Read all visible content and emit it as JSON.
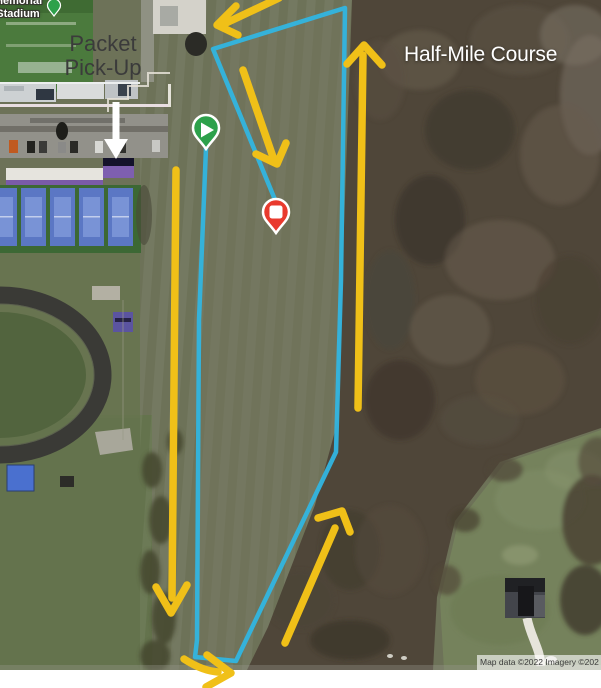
{
  "labels": {
    "packet_line1": "Packet",
    "packet_line2": "Pick-Up",
    "course": "Half-Mile Course",
    "stadium_line1": "Memorial",
    "stadium_line2": "Stadium",
    "attribution": "Map data ©2022 Imagery ©202"
  },
  "course": {
    "line_color": "#31b5e0",
    "arrow_color": "#f0c018",
    "direction_arrow_count": "6"
  },
  "markers": {
    "start": {
      "label": "course-start",
      "icon": "play-icon",
      "color": "#2da14b"
    },
    "finish": {
      "label": "course-finish",
      "icon": "stop-icon",
      "color": "#e93a2e"
    },
    "stadium_pin": {
      "label": "stadium-place-pin",
      "color": "#2da14b"
    }
  },
  "annotations": {
    "packet_arrow_color": "#ffffff",
    "packet_text_color": "#3b3b3b",
    "course_text_color": "#ffffff"
  }
}
